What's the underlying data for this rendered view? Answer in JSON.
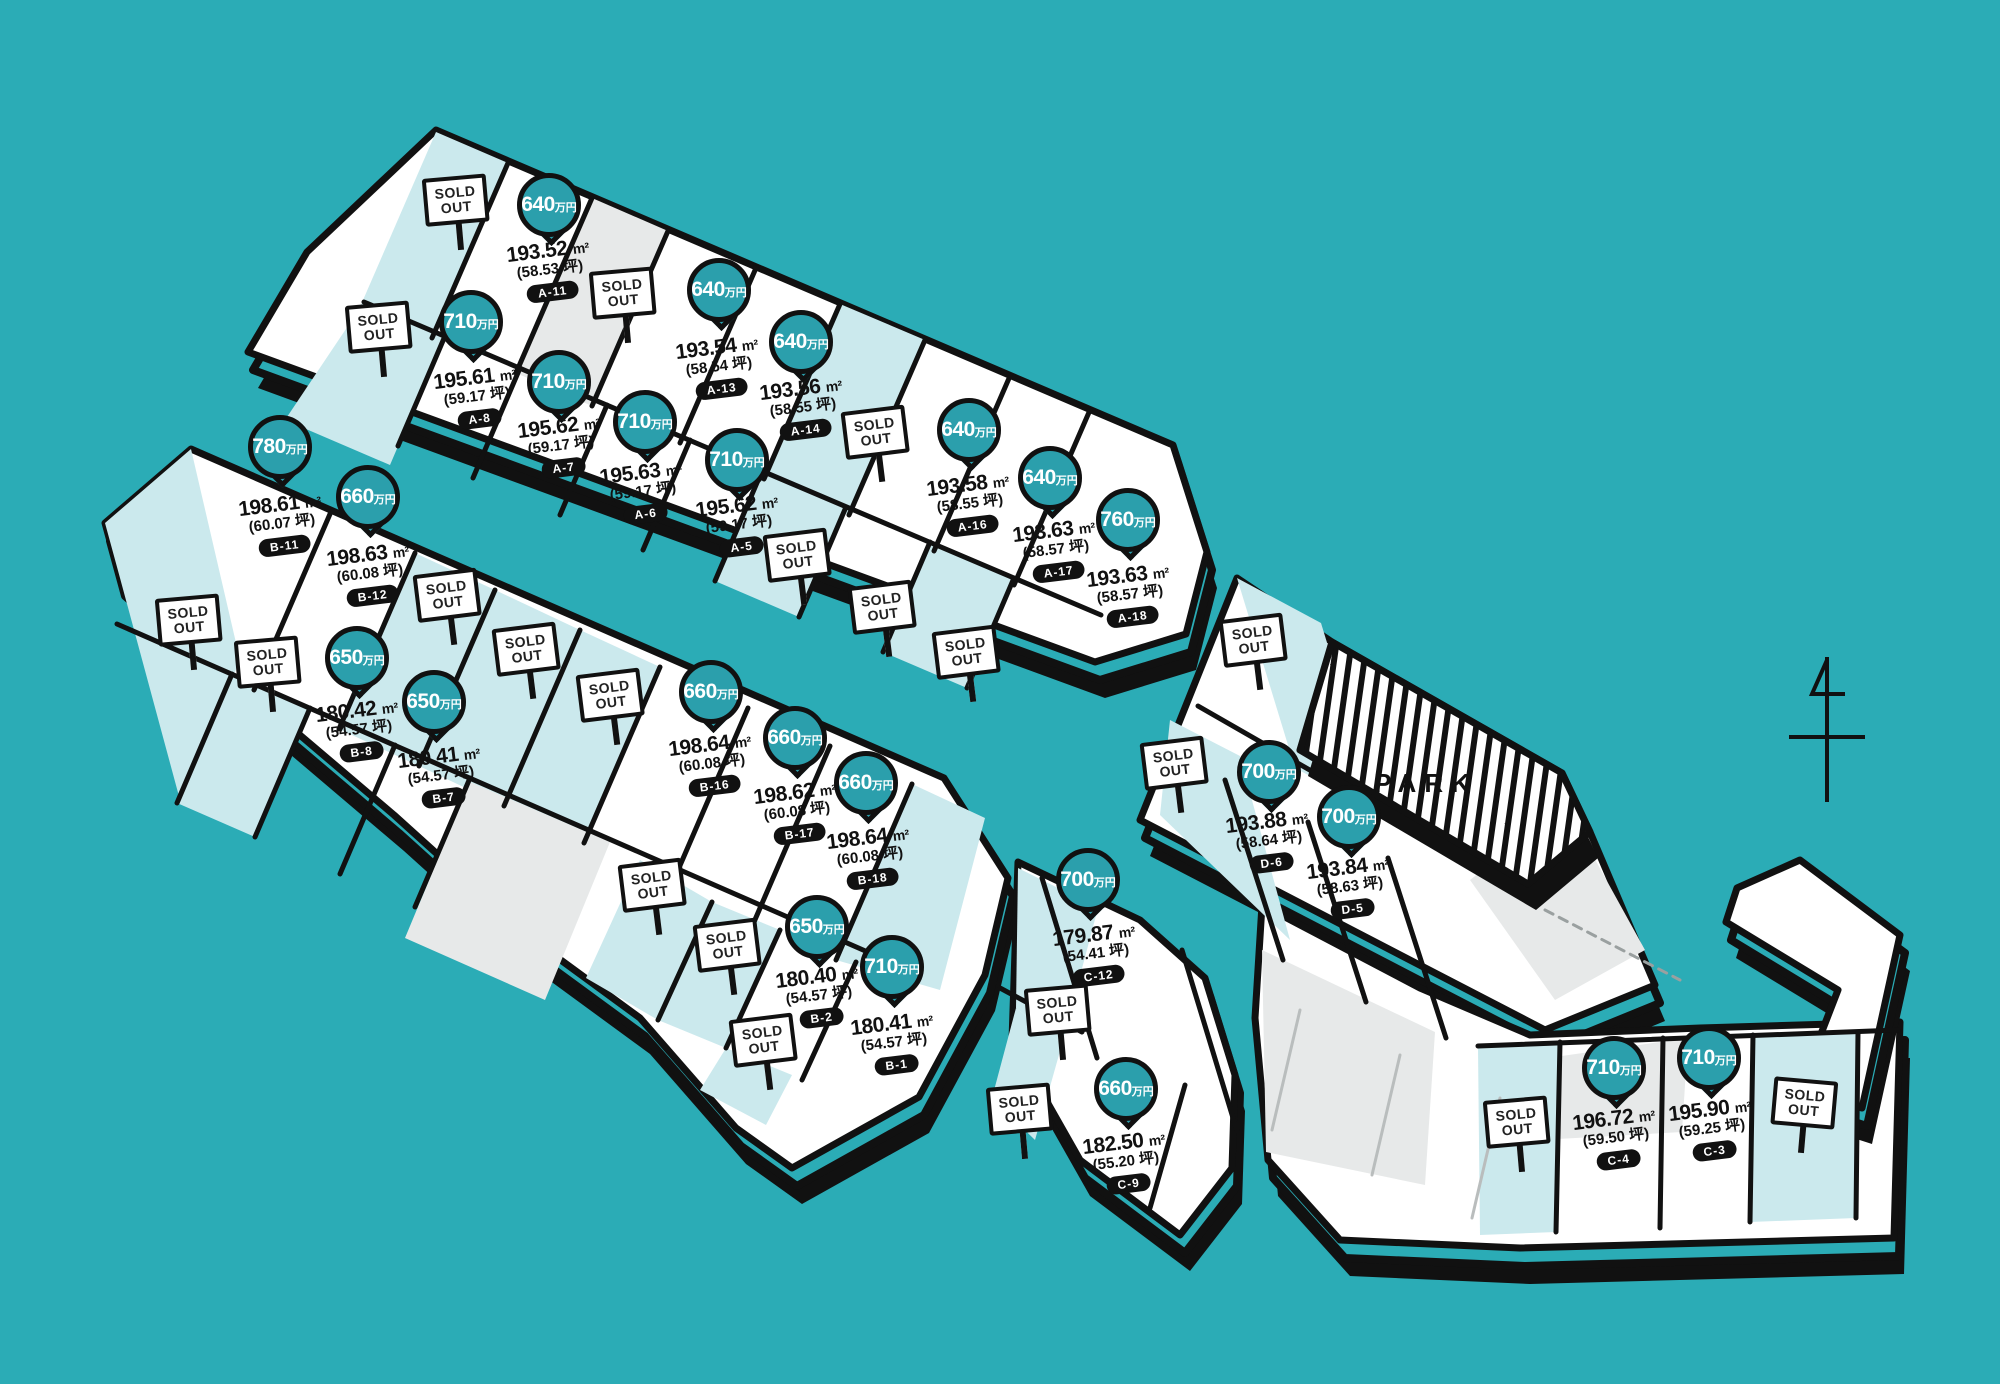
{
  "map": {
    "title": "residential-lot-price-map",
    "background_color": "#2BACB6",
    "pin_color": "#2B9FAC",
    "lot_white": "#FFFFFF",
    "lot_teal": "#CBE9ED",
    "lot_gray": "#E7E9E9",
    "outline_color": "#111111",
    "park_label": "PARK",
    "sold_out_line1": "SOLD",
    "sold_out_line2": "OUT",
    "price_unit": "万円",
    "area_unit": "m²",
    "tsubo_unit": "坪"
  },
  "lots": [
    {
      "id": "A-11",
      "price": "640",
      "area": "193.52",
      "tsubo": "58.53",
      "pin": {
        "x": 549,
        "y": 205
      },
      "label": {
        "x": 550,
        "y": 250
      }
    },
    {
      "id": "A-13",
      "price": "640",
      "area": "193.54",
      "tsubo": "58.54",
      "pin": {
        "x": 719,
        "y": 290
      },
      "label": {
        "x": 719,
        "y": 347
      }
    },
    {
      "id": "A-14",
      "price": "640",
      "area": "193.56",
      "tsubo": "58.55",
      "pin": {
        "x": 801,
        "y": 342
      },
      "label": {
        "x": 803,
        "y": 388
      }
    },
    {
      "id": "A-16",
      "price": "640",
      "area": "193.58",
      "tsubo": "58.55",
      "pin": {
        "x": 969,
        "y": 430
      },
      "label": {
        "x": 970,
        "y": 484
      }
    },
    {
      "id": "A-17",
      "price": "640",
      "area": "193.63",
      "tsubo": "58.57",
      "pin": {
        "x": 1050,
        "y": 478
      },
      "label": {
        "x": 1056,
        "y": 530
      }
    },
    {
      "id": "A-18",
      "price": "760",
      "area": "193.63",
      "tsubo": "58.57",
      "pin": {
        "x": 1128,
        "y": 520
      },
      "label": {
        "x": 1130,
        "y": 575
      }
    },
    {
      "id": "A-8",
      "price": "710",
      "area": "195.61",
      "tsubo": "59.17",
      "pin": {
        "x": 471,
        "y": 322
      },
      "label": {
        "x": 477,
        "y": 377
      }
    },
    {
      "id": "A-7",
      "price": "710",
      "area": "195.62",
      "tsubo": "59.17",
      "pin": {
        "x": 559,
        "y": 382
      },
      "label": {
        "x": 561,
        "y": 426
      }
    },
    {
      "id": "A-6",
      "price": "710",
      "area": "195.63",
      "tsubo": "59.17",
      "pin": {
        "x": 645,
        "y": 422
      },
      "label": {
        "x": 643,
        "y": 472
      }
    },
    {
      "id": "A-5",
      "price": "710",
      "area": "195.62",
      "tsubo": "59.17",
      "pin": {
        "x": 737,
        "y": 460
      },
      "label": {
        "x": 739,
        "y": 505
      }
    },
    {
      "id": "B-11",
      "price": "780",
      "area": "198.61",
      "tsubo": "60.07",
      "pin": {
        "x": 280,
        "y": 447
      },
      "label": {
        "x": 282,
        "y": 504
      }
    },
    {
      "id": "B-12",
      "price": "660",
      "area": "198.63",
      "tsubo": "60.08",
      "pin": {
        "x": 368,
        "y": 497
      },
      "label": {
        "x": 370,
        "y": 554
      }
    },
    {
      "id": "B-8",
      "price": "650",
      "area": "180.42",
      "tsubo": "54.57",
      "pin": {
        "x": 357,
        "y": 658
      },
      "label": {
        "x": 359,
        "y": 710
      }
    },
    {
      "id": "B-7",
      "price": "650",
      "area": "180.41",
      "tsubo": "54.57",
      "pin": {
        "x": 434,
        "y": 702
      },
      "label": {
        "x": 441,
        "y": 756
      }
    },
    {
      "id": "B-16",
      "price": "660",
      "area": "198.64",
      "tsubo": "60.08",
      "pin": {
        "x": 711,
        "y": 692
      },
      "label": {
        "x": 712,
        "y": 744
      }
    },
    {
      "id": "B-17",
      "price": "660",
      "area": "198.62",
      "tsubo": "60.08",
      "pin": {
        "x": 795,
        "y": 738
      },
      "label": {
        "x": 797,
        "y": 792
      }
    },
    {
      "id": "B-18",
      "price": "660",
      "area": "198.64",
      "tsubo": "60.08",
      "pin": {
        "x": 866,
        "y": 783
      },
      "label": {
        "x": 870,
        "y": 837
      }
    },
    {
      "id": "B-2",
      "price": "650",
      "area": "180.40",
      "tsubo": "54.57",
      "pin": {
        "x": 817,
        "y": 927
      },
      "label": {
        "x": 819,
        "y": 976
      }
    },
    {
      "id": "B-1",
      "price": "710",
      "area": "180.41",
      "tsubo": "54.57",
      "pin": {
        "x": 892,
        "y": 967
      },
      "label": {
        "x": 894,
        "y": 1023
      }
    },
    {
      "id": "D-6",
      "price": "700",
      "area": "193.88",
      "tsubo": "58.64",
      "pin": {
        "x": 1269,
        "y": 772
      },
      "label": {
        "x": 1269,
        "y": 821
      }
    },
    {
      "id": "D-5",
      "price": "700",
      "area": "193.84",
      "tsubo": "58.63",
      "pin": {
        "x": 1349,
        "y": 817
      },
      "label": {
        "x": 1350,
        "y": 867
      }
    },
    {
      "id": "C-12",
      "price": "700",
      "area": "179.87",
      "tsubo": "54.41",
      "pin": {
        "x": 1088,
        "y": 880
      },
      "label": {
        "x": 1096,
        "y": 934
      }
    },
    {
      "id": "C-9",
      "price": "660",
      "area": "182.50",
      "tsubo": "55.20",
      "pin": {
        "x": 1126,
        "y": 1089
      },
      "label": {
        "x": 1126,
        "y": 1142
      }
    },
    {
      "id": "C-4",
      "price": "710",
      "area": "196.72",
      "tsubo": "59.50",
      "pin": {
        "x": 1614,
        "y": 1068
      },
      "label": {
        "x": 1616,
        "y": 1118
      }
    },
    {
      "id": "C-3",
      "price": "710",
      "area": "195.90",
      "tsubo": "59.25",
      "pin": {
        "x": 1709,
        "y": 1058
      },
      "label": {
        "x": 1712,
        "y": 1109
      }
    }
  ],
  "sold_out_signs": [
    {
      "x": 458,
      "y": 200,
      "rot": -5
    },
    {
      "x": 625,
      "y": 293,
      "rot": -5
    },
    {
      "x": 381,
      "y": 327,
      "rot": -5
    },
    {
      "x": 878,
      "y": 432,
      "rot": -7
    },
    {
      "x": 800,
      "y": 555,
      "rot": -7
    },
    {
      "x": 885,
      "y": 607,
      "rot": -7
    },
    {
      "x": 969,
      "y": 652,
      "rot": -7
    },
    {
      "x": 191,
      "y": 620,
      "rot": -5
    },
    {
      "x": 270,
      "y": 662,
      "rot": -5
    },
    {
      "x": 450,
      "y": 595,
      "rot": -7
    },
    {
      "x": 529,
      "y": 649,
      "rot": -7
    },
    {
      "x": 613,
      "y": 695,
      "rot": -7
    },
    {
      "x": 655,
      "y": 885,
      "rot": -7
    },
    {
      "x": 730,
      "y": 945,
      "rot": -7
    },
    {
      "x": 766,
      "y": 1040,
      "rot": -7
    },
    {
      "x": 1256,
      "y": 640,
      "rot": -7
    },
    {
      "x": 1177,
      "y": 763,
      "rot": -7
    },
    {
      "x": 1060,
      "y": 1010,
      "rot": -5
    },
    {
      "x": 1022,
      "y": 1109,
      "rot": -5
    },
    {
      "x": 1519,
      "y": 1122,
      "rot": -5
    },
    {
      "x": 1804,
      "y": 1103,
      "rot": 5
    }
  ],
  "park": {
    "x": 1426,
    "y": 785
  }
}
